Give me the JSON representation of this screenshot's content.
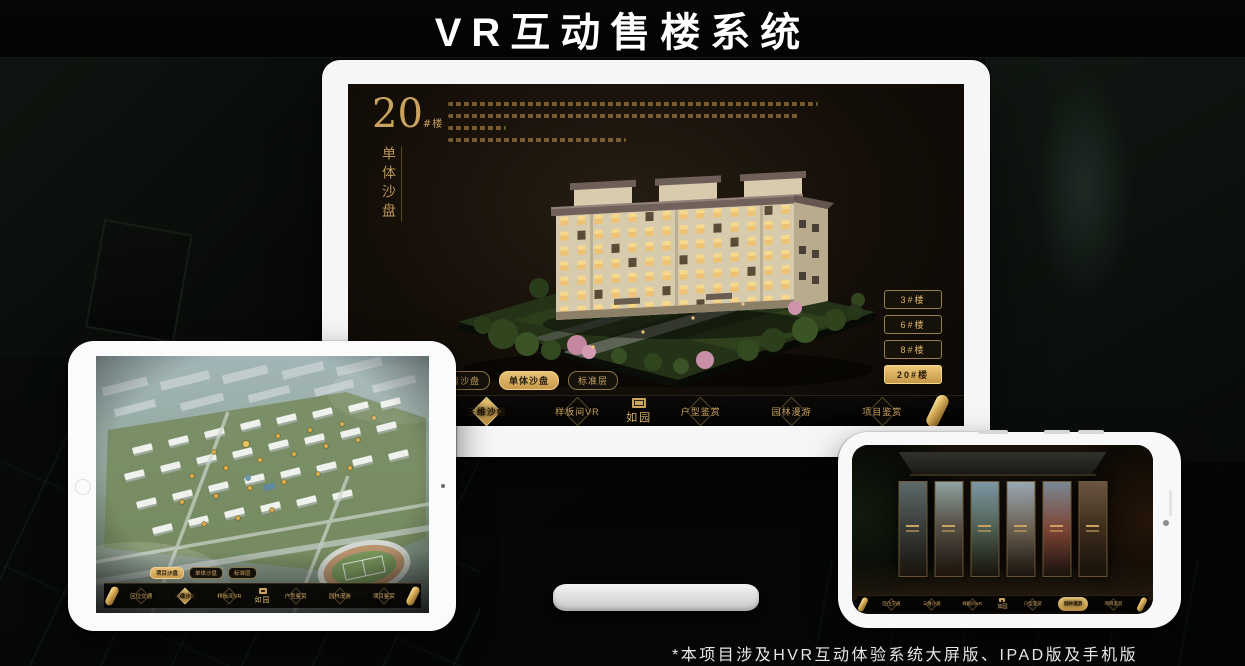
{
  "header": {
    "title": "VR互动售楼系统"
  },
  "footnote": "*本项目涉及HVR互动体验系统大屏版、IPAD版及手机版",
  "brand": {
    "logo_text": "如园"
  },
  "nav_items": [
    "区位交通",
    "三维沙盘",
    "样板间VR",
    "户型鉴赏",
    "园林漫游",
    "项目鉴赏"
  ],
  "view_tabs": [
    "项目沙盘",
    "单体沙盘",
    "标准层"
  ],
  "monitor": {
    "block_number": "20",
    "block_unit": "#楼",
    "block_subtitle": "单体沙盘",
    "building_buttons": [
      "3#楼",
      "6#楼",
      "8#楼",
      "20#楼"
    ],
    "active_building_button": "20#楼",
    "active_view_tab": "单体沙盘",
    "active_nav_item": "三维沙盘"
  },
  "tablet": {
    "active_view_tab": "项目沙盘",
    "active_nav_item": "三维沙盘"
  },
  "phone": {
    "active_nav_item": "园林漫游"
  },
  "colors": {
    "gold": "#c9a25e",
    "gold_active_bg": "#d8ab5c",
    "screen_background": "#16110c",
    "navbar_background": "#060504",
    "title_text": "#ffffff"
  }
}
